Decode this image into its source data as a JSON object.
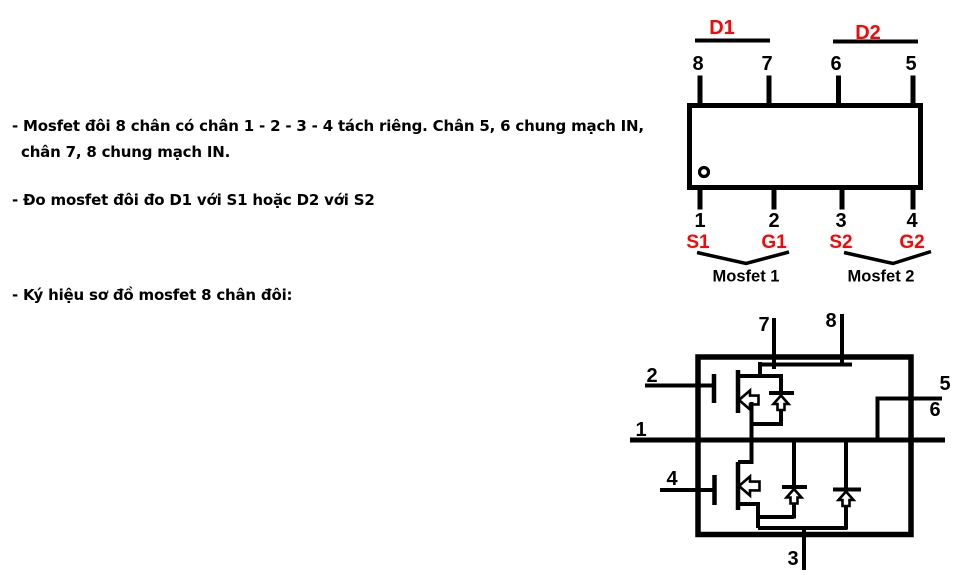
{
  "colors": {
    "background": "#ffffff",
    "ink": "#000000",
    "red_label": "#fb0505"
  },
  "notes": {
    "bullet1_line1": "- Mosfet đôi 8 chân có chân 1 - 2 - 3 - 4 tách riêng. Chân 5, 6 chung mạch IN,",
    "bullet1_line2": "chân 7, 8 chung mạch IN.",
    "bullet2": "- Đo  mosfet đôi đo D1 với S1 hoặc D2 với S2",
    "bullet3": "- Ký hiệu sơ đồ mosfet 8 chân đôi:"
  },
  "pinout": {
    "drain_labels": [
      "D1",
      "D2"
    ],
    "top_pins": [
      "8",
      "7",
      "6",
      "5"
    ],
    "bottom_pins": [
      "1",
      "2",
      "3",
      "4"
    ],
    "pin_functions": [
      "S1",
      "G1",
      "S2",
      "G2"
    ],
    "group_labels": [
      "Mosfet 1",
      "Mosfet 2"
    ]
  },
  "schematic": {
    "pin_labels": {
      "pin1": "1",
      "pin2": "2",
      "pin3": "3",
      "pin4": "4",
      "pin5": "5",
      "pin6": "6",
      "pin7": "7",
      "pin8": "8"
    }
  }
}
